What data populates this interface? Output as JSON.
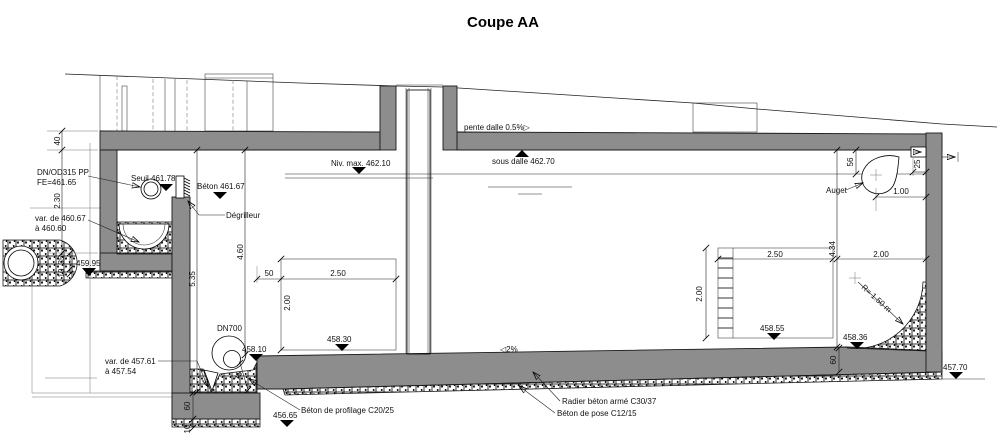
{
  "title": "Coupe AA",
  "colors": {
    "concrete": "#8d8d8d",
    "line": "#000000",
    "background": "#ffffff"
  },
  "annotations": {
    "inlet_pipe_line1": "DN/OD315 PP",
    "inlet_pipe_line2": "FE=461.65",
    "seuil": "Seuil 461.78",
    "beton_sill": "Béton 461.67",
    "degrilleur": "Dégrilleur",
    "invert_var_line1": "var. de 460.67",
    "invert_var_line2": "à 460.60",
    "level_459_95": "459.95",
    "niv_max": "Niv. max. 462.10",
    "sous_dalle": "sous dalle 462.70",
    "pente_dalle": "pente dalle 0.5%▷",
    "dn700": "DN700",
    "level_458_10": "458.10",
    "level_458_30": "458.30",
    "level_458_55": "458.55",
    "level_458_36": "458.36",
    "level_457_70": "457.70",
    "level_456_65": "456.65",
    "sump_var_line1": "var. de 457.61",
    "sump_var_line2": "à 457.54",
    "floor_slope": "◁2%",
    "auget": "Auget",
    "fillet_radius": "R= 1.50 m",
    "radier": "Radier béton armé C30/37",
    "beton_pose": "Béton de pose C12/15",
    "beton_profilage": "Béton de profilage C20/25"
  },
  "dimensions": {
    "slab_thickness": "40",
    "chamber_height": "2.30",
    "bedding_35": "35",
    "bedding_10": "10",
    "depth_5_35": "5.35",
    "depth_4_60": "4.60",
    "offset_50": "50",
    "left_pad_width": "2.50",
    "left_pad_height": "2.00",
    "right_pad_width": "2.50",
    "right_pad_height": "2.00",
    "corner_width": "2.00",
    "height_4_34": "4.34",
    "auget_56": "56",
    "auget_25": "25",
    "auget_1_00": "1.00",
    "cunette_75": "75",
    "sump_base_60": "60",
    "sump_pose_10": "10",
    "radier_60": "60"
  }
}
